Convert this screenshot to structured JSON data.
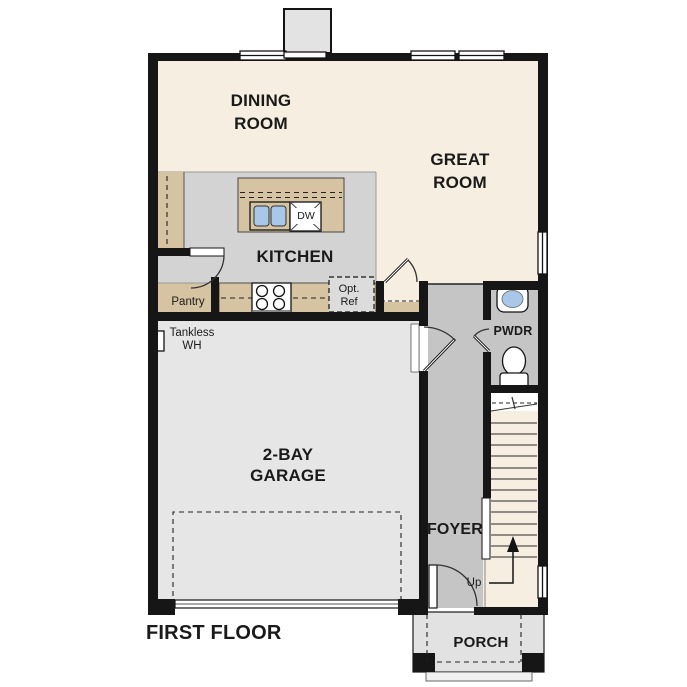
{
  "title": "FIRST FLOOR",
  "rooms": {
    "dining": "DINING ROOM",
    "great": "GREAT ROOM",
    "kitchen": "KITCHEN",
    "garage": "2-BAY GARAGE",
    "foyer": "FOYER",
    "powder": "PWDR",
    "porch": "PORCH",
    "pantry": "Pantry"
  },
  "annotations": {
    "dishwasher": "DW",
    "optional_refrigerator": "Opt. Ref",
    "tankless_water_heater": "Tankless WH",
    "stairs_up": "Up"
  },
  "colors": {
    "floor_cream": "#f6eee0",
    "floor_kitchen": "#d3d3d3",
    "floor_hall": "#c5c5c5",
    "floor_garage": "#e6e6e6",
    "floor_porch": "#e2e2e2",
    "counter_tan": "#d6c3a1",
    "sink_blue": "#a9c7e9",
    "wall": "#161616"
  }
}
